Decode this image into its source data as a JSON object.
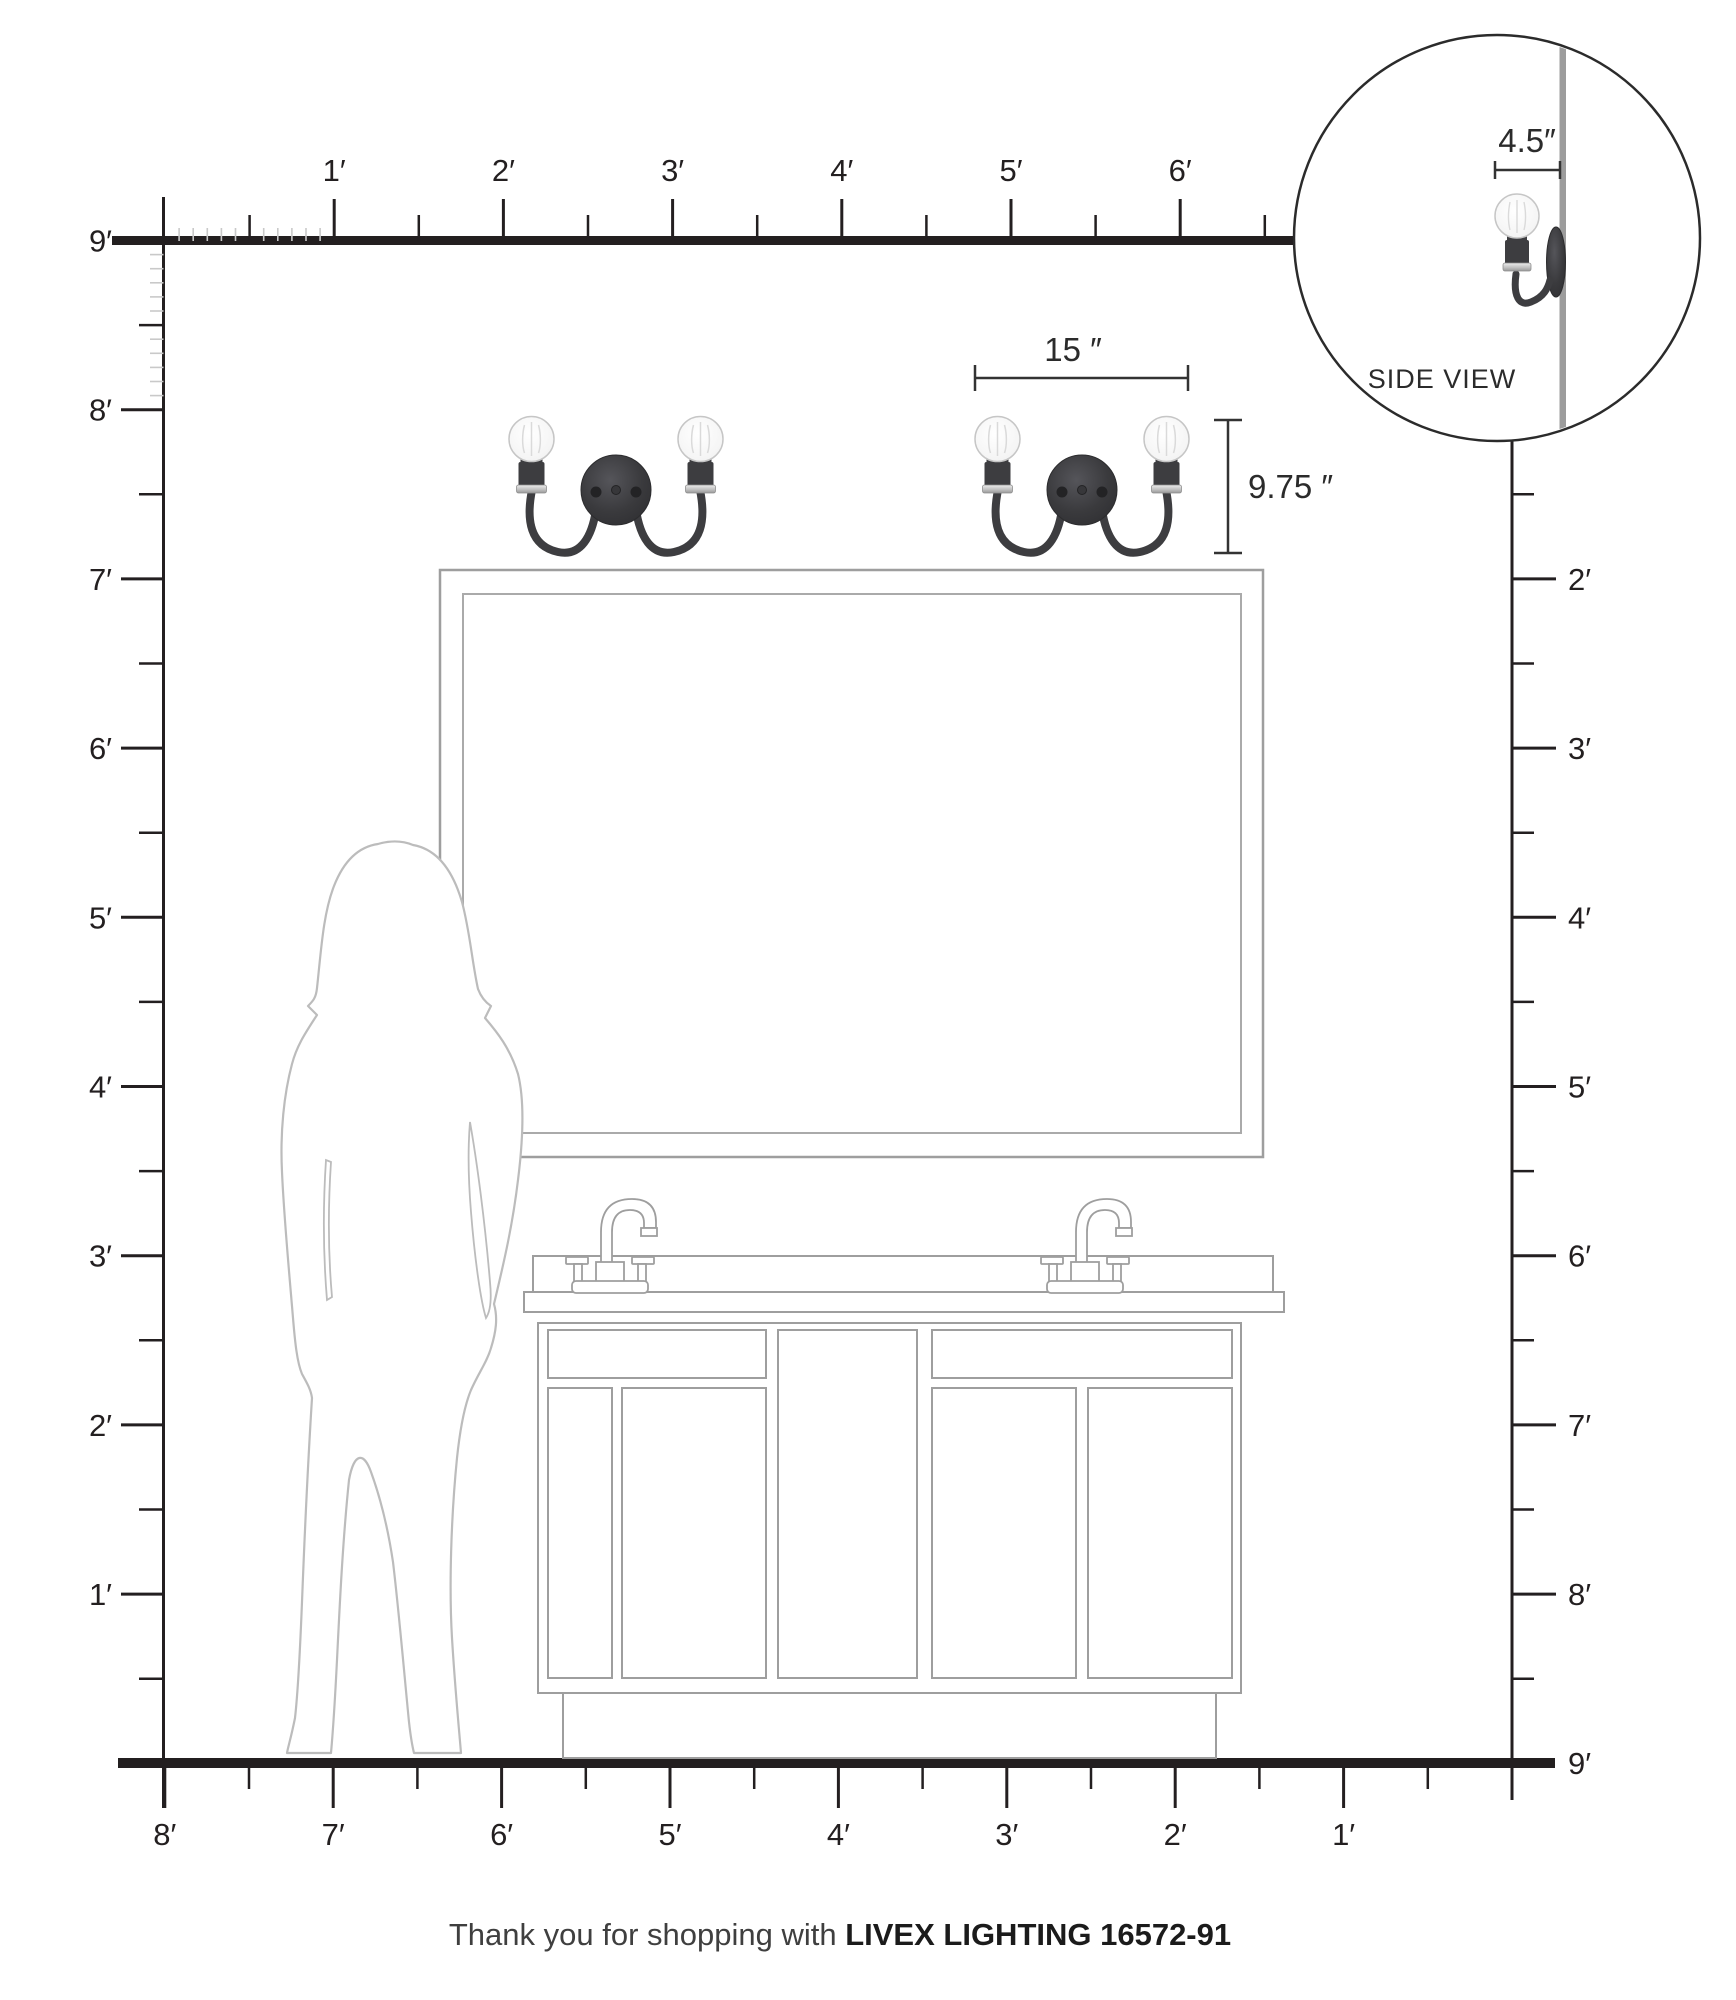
{
  "rulers": {
    "top_labels": [
      "1′",
      "2′",
      "3′",
      "4′",
      "5′",
      "6′"
    ],
    "left_labels": [
      "9′",
      "8′",
      "7′",
      "6′",
      "5′",
      "4′",
      "3′",
      "2′",
      "1′"
    ],
    "right_labels": [
      "2′",
      "3′",
      "4′",
      "5′",
      "6′",
      "7′",
      "8′",
      "9′"
    ],
    "bottom_labels": [
      "8′",
      "7′",
      "6′",
      "5′",
      "4′",
      "3′",
      "2′",
      "1′"
    ]
  },
  "dimensions": {
    "fixture_width": "15 ″",
    "fixture_height": "9.75 ″",
    "fixture_depth": "4.5″"
  },
  "side_view": {
    "label": "SIDE VIEW"
  },
  "footer": {
    "prefix": "Thank you for shopping with ",
    "brand": "LIVEX LIGHTING 16572-91"
  },
  "colors": {
    "ink": "#231f20",
    "faint": "#c9c9c9",
    "furniture": "#9e9e9e",
    "silhouette": "#bcbcbc",
    "fixture": "#3d3d40",
    "wall": "#9c9c9c"
  }
}
